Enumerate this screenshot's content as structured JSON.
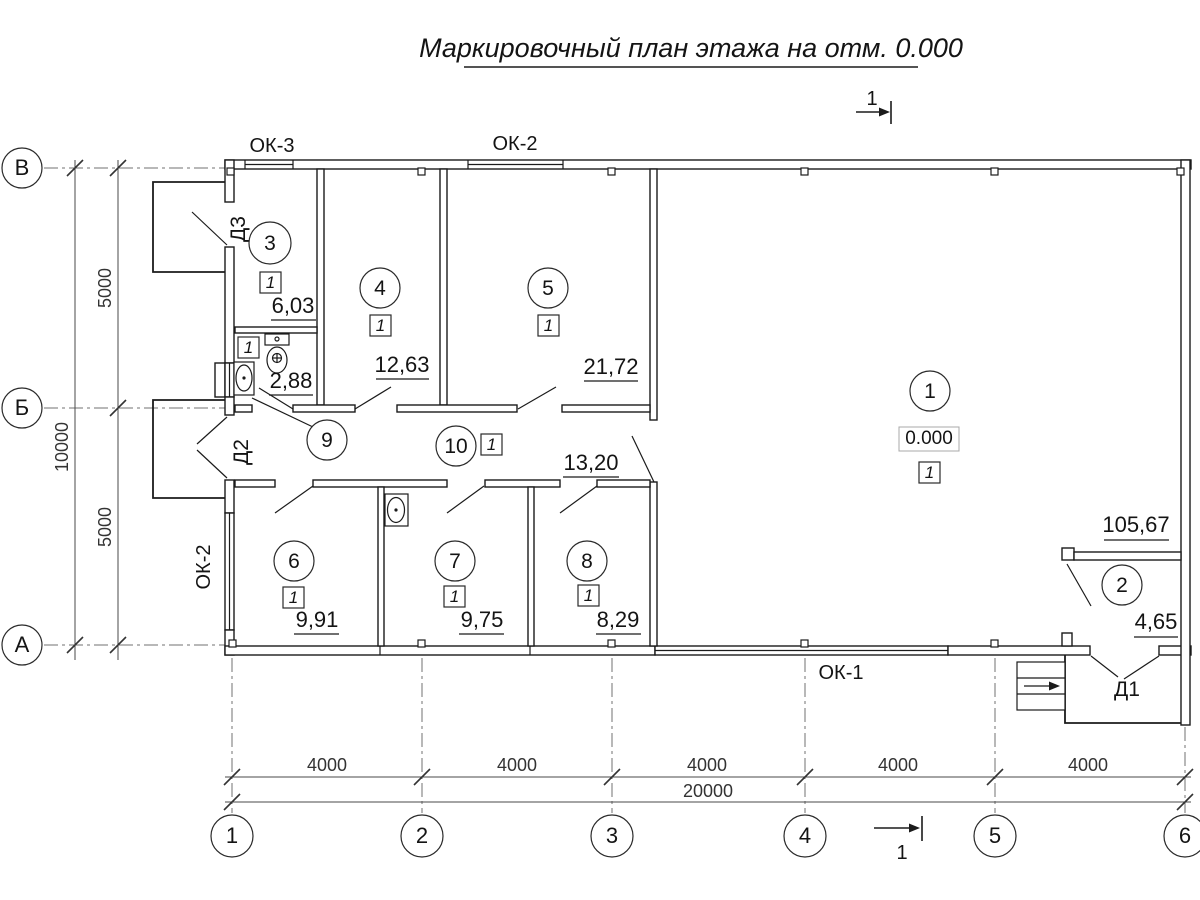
{
  "title": "Маркировочный план этажа на отм. 0.000",
  "section": {
    "label": "1"
  },
  "axes": {
    "rows": [
      {
        "label": "В"
      },
      {
        "label": "Б"
      },
      {
        "label": "А"
      }
    ],
    "cols": [
      {
        "label": "1"
      },
      {
        "label": "2"
      },
      {
        "label": "3"
      },
      {
        "label": "4"
      },
      {
        "label": "5"
      },
      {
        "label": "6"
      }
    ]
  },
  "dimensions": {
    "left": {
      "upper": "5000",
      "lower": "5000",
      "total": "10000"
    },
    "bottom": {
      "spans": [
        {
          "label": "4000"
        },
        {
          "label": "4000"
        },
        {
          "label": "4000"
        },
        {
          "label": "4000"
        },
        {
          "label": "4000"
        }
      ],
      "total": "20000"
    }
  },
  "windows": {
    "top_left": "ОК-3",
    "top_center": "ОК-2",
    "left": "ОК-2",
    "bottom": "ОК-1"
  },
  "doors": {
    "d1": "Д1",
    "d2": "Д2",
    "d3": "Д3"
  },
  "elevation_mark": "0.000",
  "rooms": [
    {
      "number": "1",
      "area": "105,67",
      "floor_type": "1"
    },
    {
      "number": "2",
      "area": "4,65"
    },
    {
      "number": "3",
      "area": "6,03",
      "floor_type": "1"
    },
    {
      "number": "4",
      "area": "12,63",
      "floor_type": "1"
    },
    {
      "number": "5",
      "area": "21,72",
      "floor_type": "1"
    },
    {
      "number": "6",
      "area": "9,91",
      "floor_type": "1"
    },
    {
      "number": "7",
      "area": "9,75",
      "floor_type": "1"
    },
    {
      "number": "8",
      "area": "8,29",
      "floor_type": "1"
    },
    {
      "number": "9",
      "area": "2,88",
      "floor_type": "1"
    },
    {
      "number": "10",
      "area": "13,20",
      "floor_type": "1"
    }
  ]
}
